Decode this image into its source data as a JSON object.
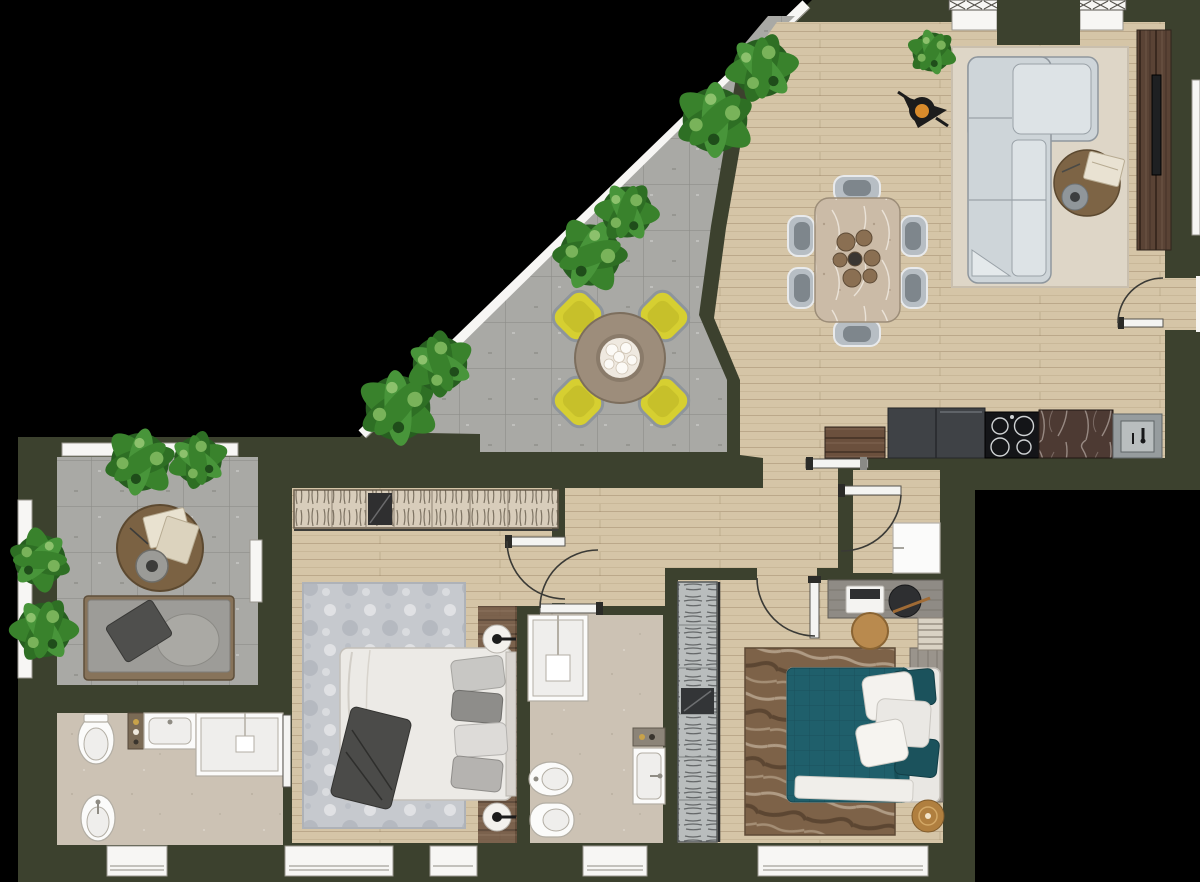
{
  "image": {
    "kind": "apartment floor plan, top-down rendered view",
    "background": "#000000",
    "visible_text": "none"
  },
  "palette": {
    "background": "#000000",
    "wall": "#3c412e",
    "wood_floor": "#d5c5a7",
    "terrace_tile": "#a9a9a5",
    "bath_tile": "#ccc2b4",
    "rug_living": "#ded6c7",
    "rug_master": "#c6c9ce",
    "rug_bedroom2": "#7d6248",
    "sofa": "#ced5d9",
    "dining_table": "#cbbba7",
    "chair_gray": "#b7bec4",
    "terrace_table": "#9d8d7b",
    "terrace_chair_yellow": "#d6cf31",
    "kitchen_cabinet": "#3f4246",
    "kitchen_hob": "#141518",
    "kitchen_counter_marble": "#4d3a33",
    "kitchen_sink": "#969c9e",
    "tv_console_wood": "#5a4335",
    "wardrobe_master": "#d8cdbb",
    "wardrobe_bedroom2": "#b9bdbd",
    "bed_white": "#eceae6",
    "bed_teal": "#1f5f6b",
    "pillow_gray": "#a7a5a1",
    "throw_dark": "#4b4b49",
    "plant_green_dark": "#275e20",
    "plant_green_mid": "#39822c",
    "plant_green_light": "#79b35a",
    "door_white": "#f4f4f2",
    "window_white": "#f7f6f4",
    "lamp_black": "#1c1c1c",
    "lamp_orange": "#d98b2b",
    "disc_bronze": "#b07f3f"
  },
  "rooms": [
    {
      "name": "terrace",
      "floor": "concrete tiles",
      "features": [
        "diagonal glazed facade",
        "round table",
        "4 yellow chairs",
        "3 plant groups"
      ]
    },
    {
      "name": "living-dining-room",
      "floor": "wood",
      "features": [
        "L-shaped sofa",
        "area rug",
        "round coffee table",
        "TV console",
        "dining table with 6 chairs",
        "floor lamp",
        "plant"
      ]
    },
    {
      "name": "kitchen",
      "floor": "wood",
      "features": [
        "cabinets",
        "induction hob",
        "marble counter",
        "sink",
        "sideboard"
      ]
    },
    {
      "name": "hallway",
      "floor": "wood",
      "features": [
        "doors to bedrooms and bathroom"
      ]
    },
    {
      "name": "master-bedroom",
      "floor": "wood",
      "features": [
        "wardrobe with clothes",
        "double bed",
        "patterned rug",
        "two lamps",
        "wood runner"
      ]
    },
    {
      "name": "bedroom-2",
      "floor": "wood",
      "features": [
        "glass wardrobe",
        "teal double bed",
        "distressed brown rug",
        "desk with laptop",
        "stool",
        "bookshelf",
        "bronze disc"
      ]
    },
    {
      "name": "bathroom-1",
      "floor": "beige tile",
      "features": [
        "toilet",
        "bidet",
        "basin counter",
        "shower",
        "shelf"
      ]
    },
    {
      "name": "bathroom-2",
      "floor": "beige tile",
      "features": [
        "shower",
        "bidet",
        "toilet",
        "wall basin",
        "shelf"
      ]
    },
    {
      "name": "loggia",
      "floor": "concrete tiles",
      "features": [
        "round coffee table",
        "bench sofa",
        "plants"
      ]
    },
    {
      "name": "utility-niche",
      "floor": "wood",
      "features": [
        "white appliance cabinet"
      ]
    }
  ]
}
